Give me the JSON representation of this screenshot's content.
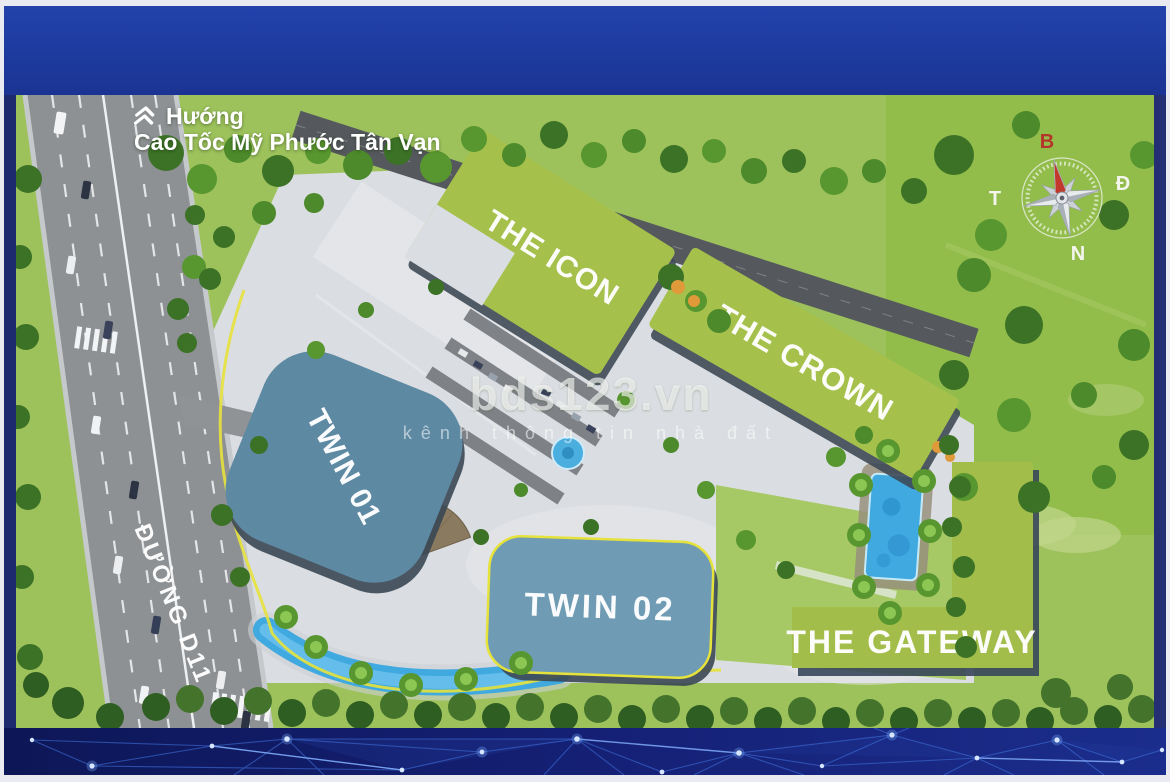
{
  "photo": {
    "direction": {
      "icon": "double-chevron-up",
      "line1": "Hướng",
      "line2": "Cao Tốc Mỹ Phước Tân Vạn"
    },
    "road_label": "ĐƯỜNG D11",
    "buildings": {
      "the_icon": {
        "label": "THE ICON",
        "roof_color": "#a6c04c"
      },
      "the_crown": {
        "label": "THE CROWN",
        "roof_color": "#a6c04c"
      },
      "twin_01": {
        "label": "TWIN 01",
        "roof_color": "#5d89a3"
      },
      "twin_02": {
        "label": "TWIN 02",
        "roof_color": "#6f9cb4"
      },
      "the_gateway": {
        "label": "THE GATEWAY",
        "roof_color": "#a2bd4a"
      }
    },
    "compass": {
      "north": "B",
      "east": "Đ",
      "south": "N",
      "west": "T",
      "north_color": "#b5342a"
    },
    "watermark": {
      "title": "bds123.vn",
      "subtitle": "kênh thông tin nhà đất"
    },
    "colors": {
      "banner_blue": "#1e3a9e",
      "band_navy": "#101c5e",
      "accent_yellow": "#e6e23c",
      "pool_blue": "#3fa9e0",
      "grass": "#9dc25c",
      "plaza": "#dadde1"
    }
  }
}
